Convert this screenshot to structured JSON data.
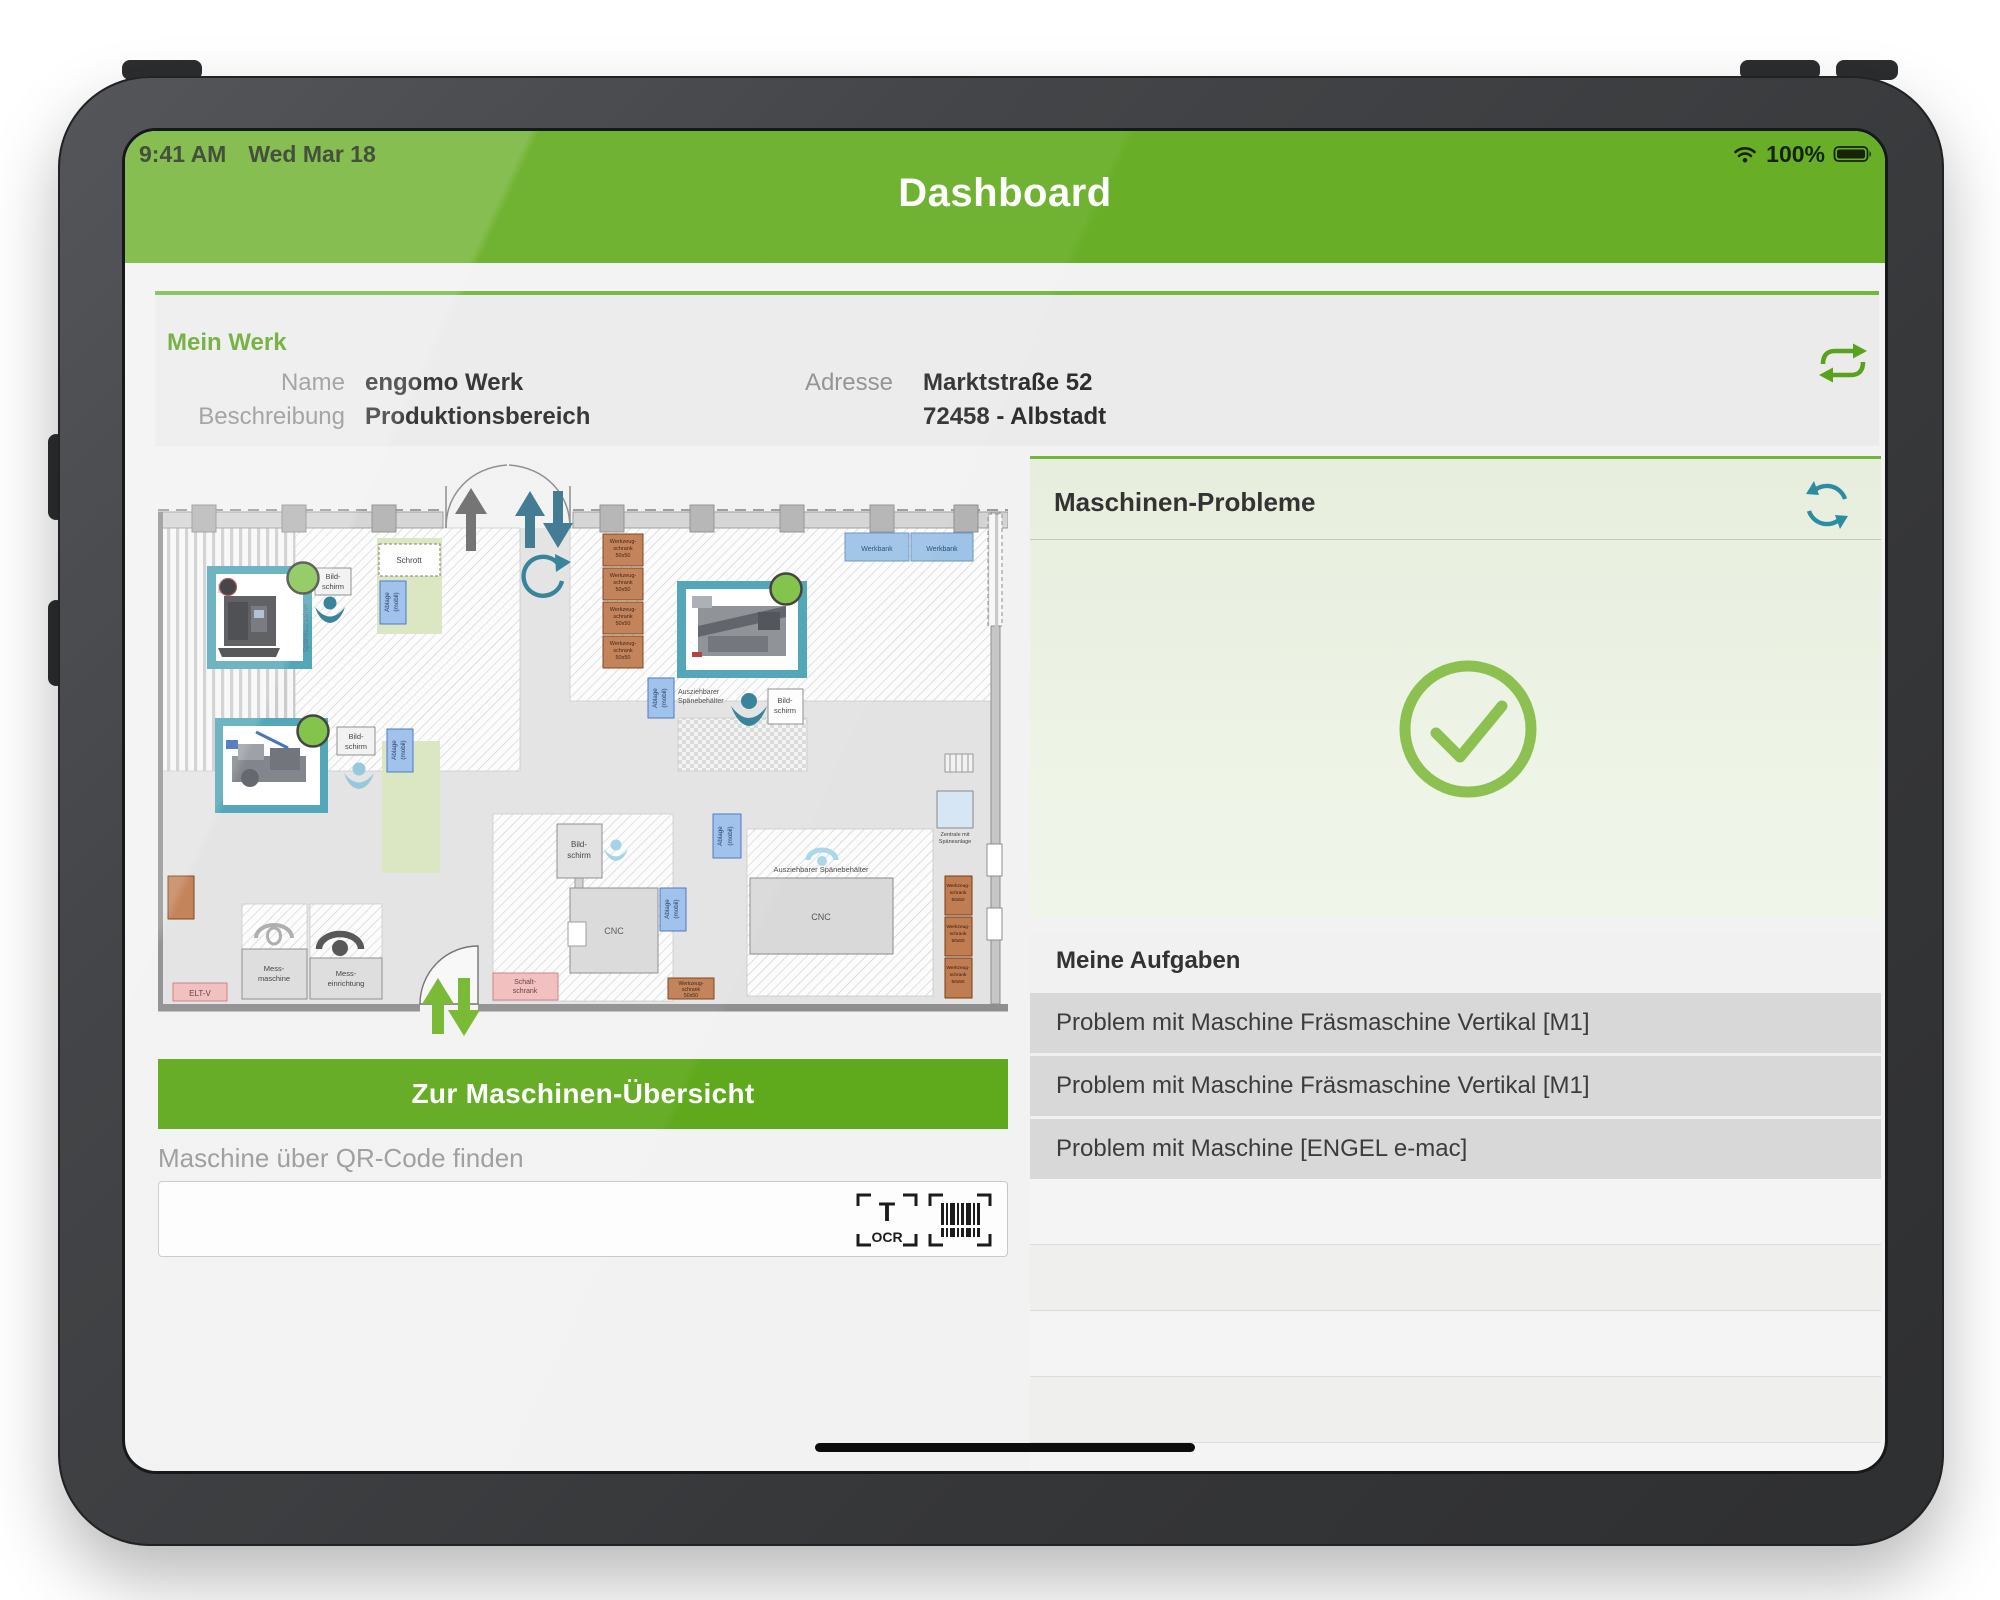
{
  "status_bar": {
    "time": "9:41 AM",
    "date": "Wed Mar 18",
    "battery": "100%"
  },
  "header": {
    "title": "Dashboard"
  },
  "mein_werk": {
    "section_title": "Mein Werk",
    "name_label": "Name",
    "name_value": "engomo Werk",
    "beschreibung_label": "Beschreibung",
    "beschreibung_value": "Produktionsbereich",
    "adresse_label": "Adresse",
    "adresse_value": "Marktstraße 52",
    "adresse_value2": "72458 - Albstadt"
  },
  "left": {
    "overview_button": "Zur Maschinen-Übersicht",
    "qr_label": "Maschine über QR-Code finden",
    "qr_input_value": "",
    "ocr_text": "OCR"
  },
  "plan": {
    "labels": {
      "bild1": "Bild-",
      "bild2": "schirm",
      "schrott": "Schrott",
      "ablage1": "Ablage",
      "ablage2": "(mobil)",
      "wz1": "Werkzeug-",
      "wz2": "schrank",
      "wz3": "50x50",
      "werkbank": "Werkbank",
      "cnc": "CNC",
      "auszieh1": "Ausziehbarer",
      "auszieh2": "Spänebehälter",
      "auszieh_full": "Ausziehbarer Spänebehälter",
      "mess1": "Mess-",
      "mess2": "maschine",
      "messe1": "Mess-",
      "messe2": "einrichtung",
      "eltv": "ELT-V",
      "schalt1": "Schalt-",
      "schalt2": "schrank",
      "zentrale1": "Zentrale mit",
      "zentrale2": "Späneanlage",
      "spaene": "Spänecontainer"
    }
  },
  "right": {
    "problems_title": "Maschinen-Probleme",
    "tasks_title": "Meine Aufgaben",
    "tasks": [
      "Problem mit Maschine Fräsmaschine Vertikal [M1]",
      "Problem mit Maschine Fräsmaschine Vertikal [M1]",
      "Problem mit Maschine  [ENGEL e-mac]"
    ]
  },
  "colors": {
    "brand_green": "#68ae26",
    "button_green": "#5fa91c",
    "accent_green": "#72b63c",
    "check_green": "#8cc152",
    "marker_green": "#7cc143",
    "teal": "#2b8ca3",
    "task_gray": "#d8d8d8"
  }
}
